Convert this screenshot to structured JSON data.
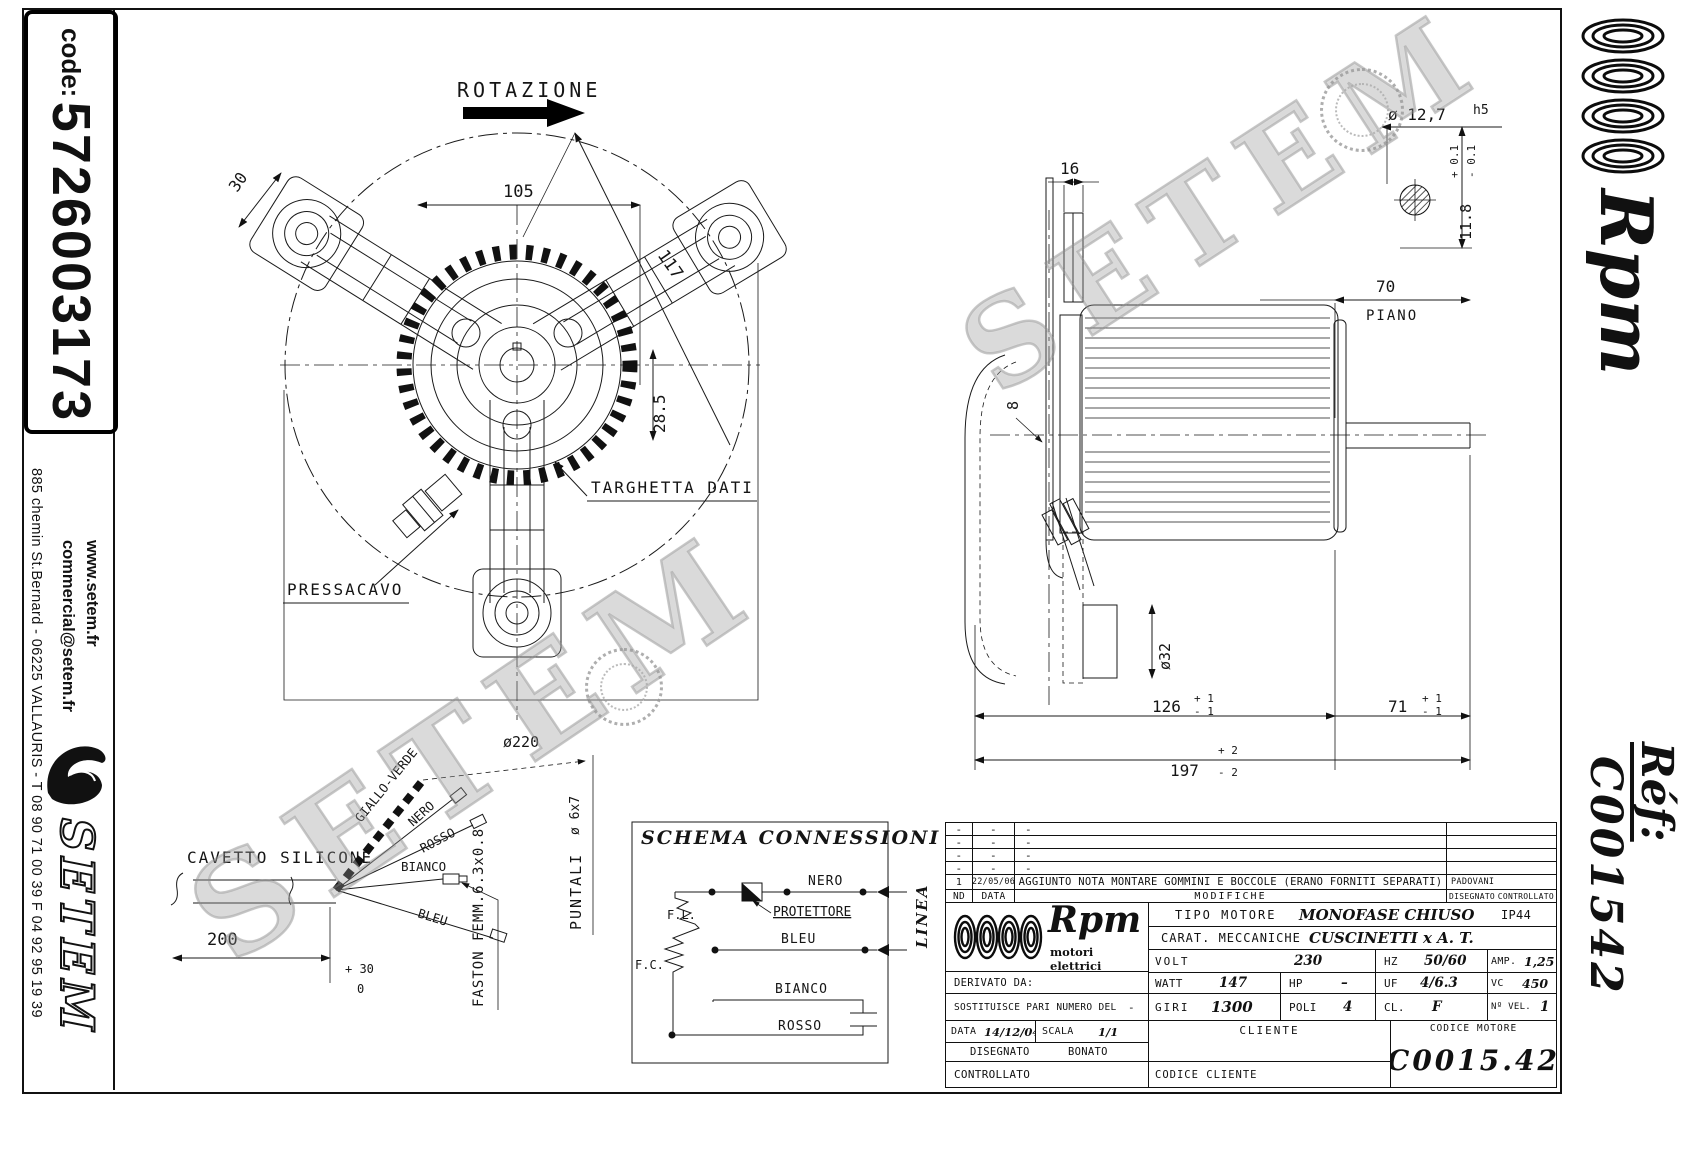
{
  "sheet": {
    "code_label": "code:",
    "code_value": "5726003173",
    "address": "885 chemin St.Bernard  -  06225 VALLAURIS  -  T 08 90 71 00 39   F 04 92 95 19 39",
    "website": "www.setem.fr",
    "email": "commercial@setem.fr",
    "supplier_logo": "SETEM"
  },
  "right_strip": {
    "brand": "Rpm",
    "ref_label": "Réf:",
    "ref_value": "C001542"
  },
  "watermark": {
    "text": "SETEM"
  },
  "fan_view": {
    "rotation_label": "ROTAZIONE",
    "dim_width": "105",
    "dim_diag": "117",
    "dim_pad": "30",
    "dim_offset": "28.5",
    "dim_diameter": "ø220",
    "label_nameplate": "TARGHETTA DATI",
    "label_gland": "PRESSACAVO"
  },
  "side_view": {
    "dim_bracket": "16",
    "dim_plate": "8",
    "dim_shaft_dia": "ø 12,7",
    "dim_shaft_fit": "h5",
    "dim_key": "11.8",
    "dim_key_tol_plus": "+ 0.1",
    "dim_key_tol_minus": "- 0.1",
    "dim_shaft_len": "70",
    "label_plane": "PIANO",
    "dim_boss": "ø32",
    "dim_body": "126",
    "dim_body_tol_plus": "+ 1",
    "dim_body_tol_minus": "- 1",
    "dim_shaft_ext": "71",
    "dim_shaft_ext_tol_plus": "+ 1",
    "dim_shaft_ext_tol_minus": "- 1",
    "dim_total": "197",
    "dim_total_tol_plus": "+ 2",
    "dim_total_tol_minus": "- 2"
  },
  "wiring": {
    "label_cable": "CAVETTO SILICONE",
    "wire_1": "GIALLO-VERDE",
    "wire_2": "NERO",
    "wire_3": "ROSSO",
    "wire_4": "BIANCO",
    "wire_5": "BLEU",
    "dim_length": "200",
    "dim_length_tol_plus": "+ 30",
    "dim_length_tol_minus": "0",
    "label_terminals": "FASTON FEMM.6.3x0.8",
    "label_tips": "PUNTALI",
    "dim_tips": "ø 6x7"
  },
  "schema": {
    "title": "SCHEMA CONNESSIONI",
    "label_fl": "F.L.",
    "label_fc": "F.C.",
    "label_protector": "PROTETTORE",
    "wire_black": "NERO",
    "wire_blue": "BLEU",
    "wire_white": "BIANCO",
    "wire_red": "ROSSO",
    "label_line": "LINEA"
  },
  "revisions": {
    "dash": "-",
    "rev1_no": "1",
    "rev1_date": "22/05/06",
    "rev1_desc": "AGGIUNTO NOTA MONTARE GOMMINI E BOCCOLE (ERANO FORNITI SEPARATI)",
    "rev1_by": "PADOVANI",
    "col_no": "ND",
    "col_date": "DATA",
    "col_desc": "MODIFICHE",
    "col_drawn": "DISEGNATO",
    "col_checked": "CONTROLLATO"
  },
  "titleblock": {
    "brand": "Rpm",
    "brand_sub": "motori elettrici",
    "motor_type_label": "TIPO MOTORE",
    "motor_type": "MONOFASE CHIUSO",
    "protection": "IP44",
    "mech_label": "CARAT. MECCANICHE",
    "mech": "CUSCINETTI x A. T.",
    "volt_label": "VOLT",
    "volt": "230",
    "hz_label": "HZ",
    "hz": "50/60",
    "amp_label": "AMP.",
    "amp": "1,25",
    "derived_label": "DERIVATO DA:",
    "watt_label": "WATT",
    "watt": "147",
    "hp_label": "HP",
    "hp": "–",
    "uf_label": "UF",
    "uf": "4/6.3",
    "vc_label": "VC",
    "vc": "450",
    "replaces_label": "SOSTITUISCE PARI NUMERO DEL",
    "replaces": "-",
    "rpm_label": "GIRI",
    "rpm": "1300",
    "poles_label": "POLI",
    "poles": "4",
    "class_label": "CL.",
    "class_value": "F",
    "speeds_label": "Nº VEL.",
    "speeds": "1",
    "date_label": "DATA",
    "date": "14/12/04",
    "scale_label": "SCALA",
    "scale": "1/1",
    "client_label": "CLIENTE",
    "drawn_label": "DISEGNATO",
    "drawn": "BONATO",
    "checked_label": "CONTROLLATO",
    "client_code_label": "CODICE CLIENTE",
    "motor_code_label": "CODICE MOTORE",
    "motor_code": "C0015.42"
  }
}
